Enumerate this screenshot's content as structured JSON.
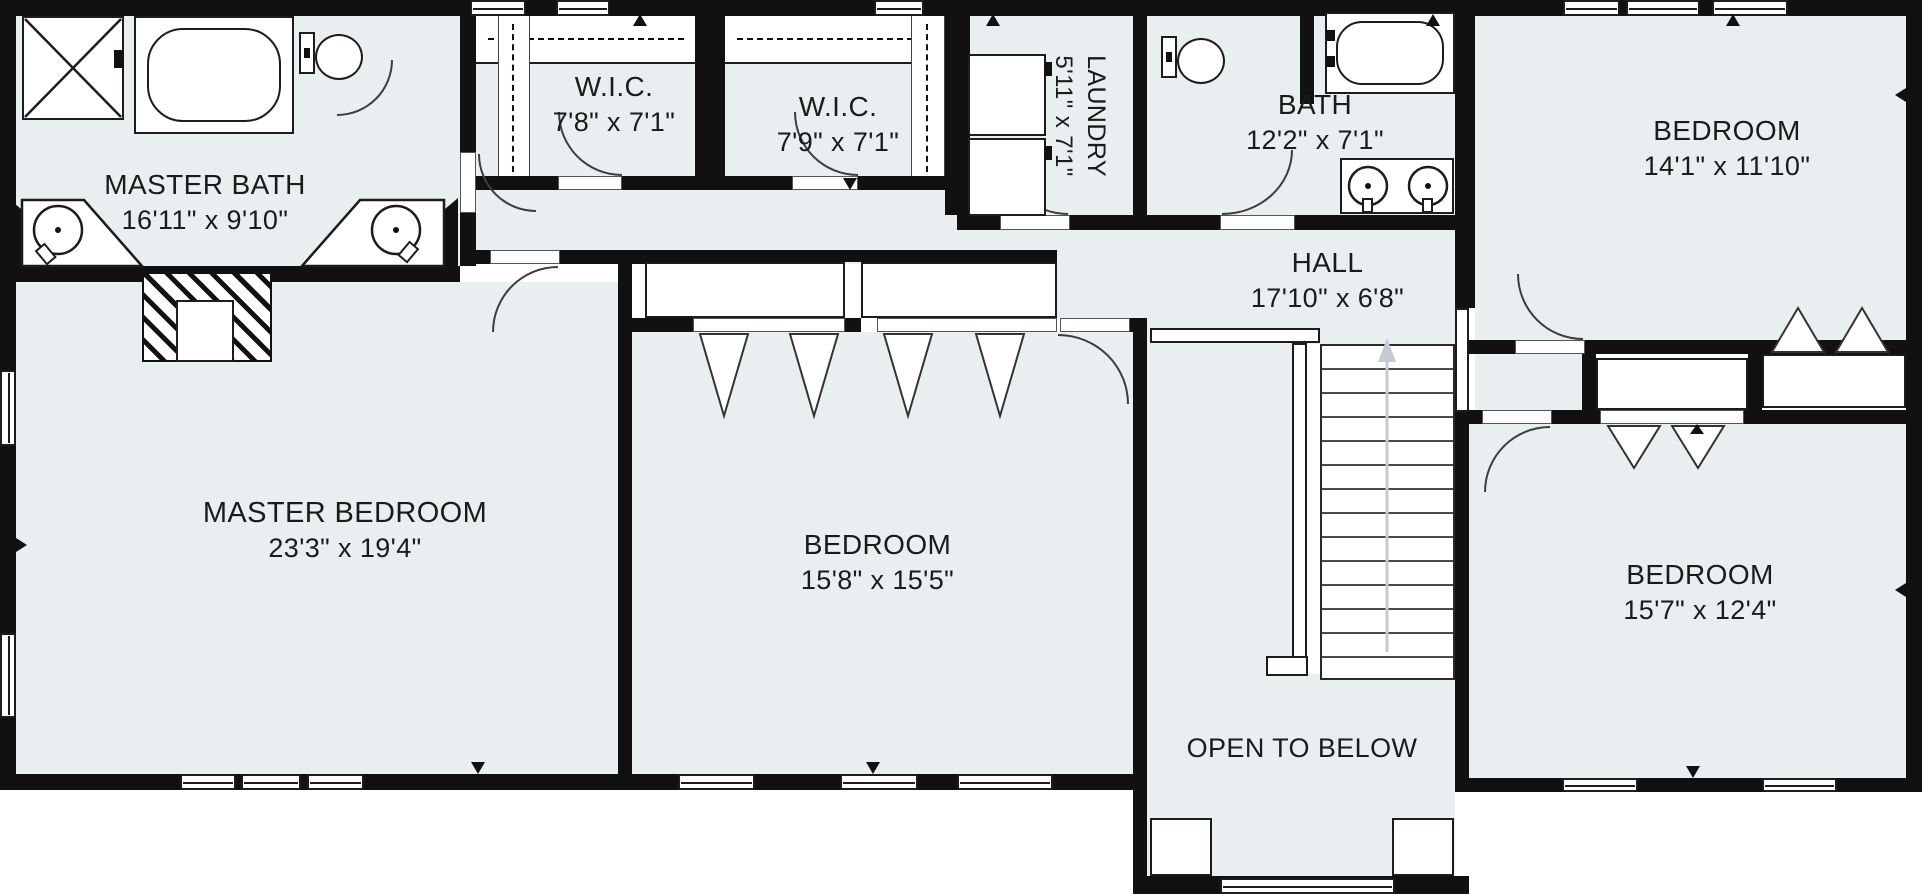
{
  "plan_title": "Second floor residential floor plan",
  "rooms": {
    "master_bath": {
      "name": "MASTER BATH",
      "dims": "16'11\" x 9'10\""
    },
    "wic1": {
      "name": "W.I.C.",
      "dims": "7'8\" x 7'1\""
    },
    "wic2": {
      "name": "W.I.C.",
      "dims": "7'9\" x 7'1\""
    },
    "laundry": {
      "name": "LAUNDRY",
      "dims": "5'11\" x 7'1\""
    },
    "bath": {
      "name": "BATH",
      "dims": "12'2\" x 7'1\""
    },
    "bedroom_top_right": {
      "name": "BEDROOM",
      "dims": "14'1\" x 11'10\""
    },
    "hall": {
      "name": "HALL",
      "dims": "17'10\" x 6'8\""
    },
    "master_bedroom": {
      "name": "MASTER BEDROOM",
      "dims": "23'3\" x 19'4\""
    },
    "bedroom_middle": {
      "name": "BEDROOM",
      "dims": "15'8\" x 15'5\""
    },
    "bedroom_bottom_right": {
      "name": "BEDROOM",
      "dims": "15'7\" x 12'4\""
    },
    "open_below": {
      "label": "OPEN TO BELOW"
    }
  },
  "colors": {
    "floor": "#e9eef1",
    "wall": "#111111",
    "outline": "#1c1c1c",
    "stair_arrow": "#c3cad0",
    "text": "#1b1b1b"
  }
}
